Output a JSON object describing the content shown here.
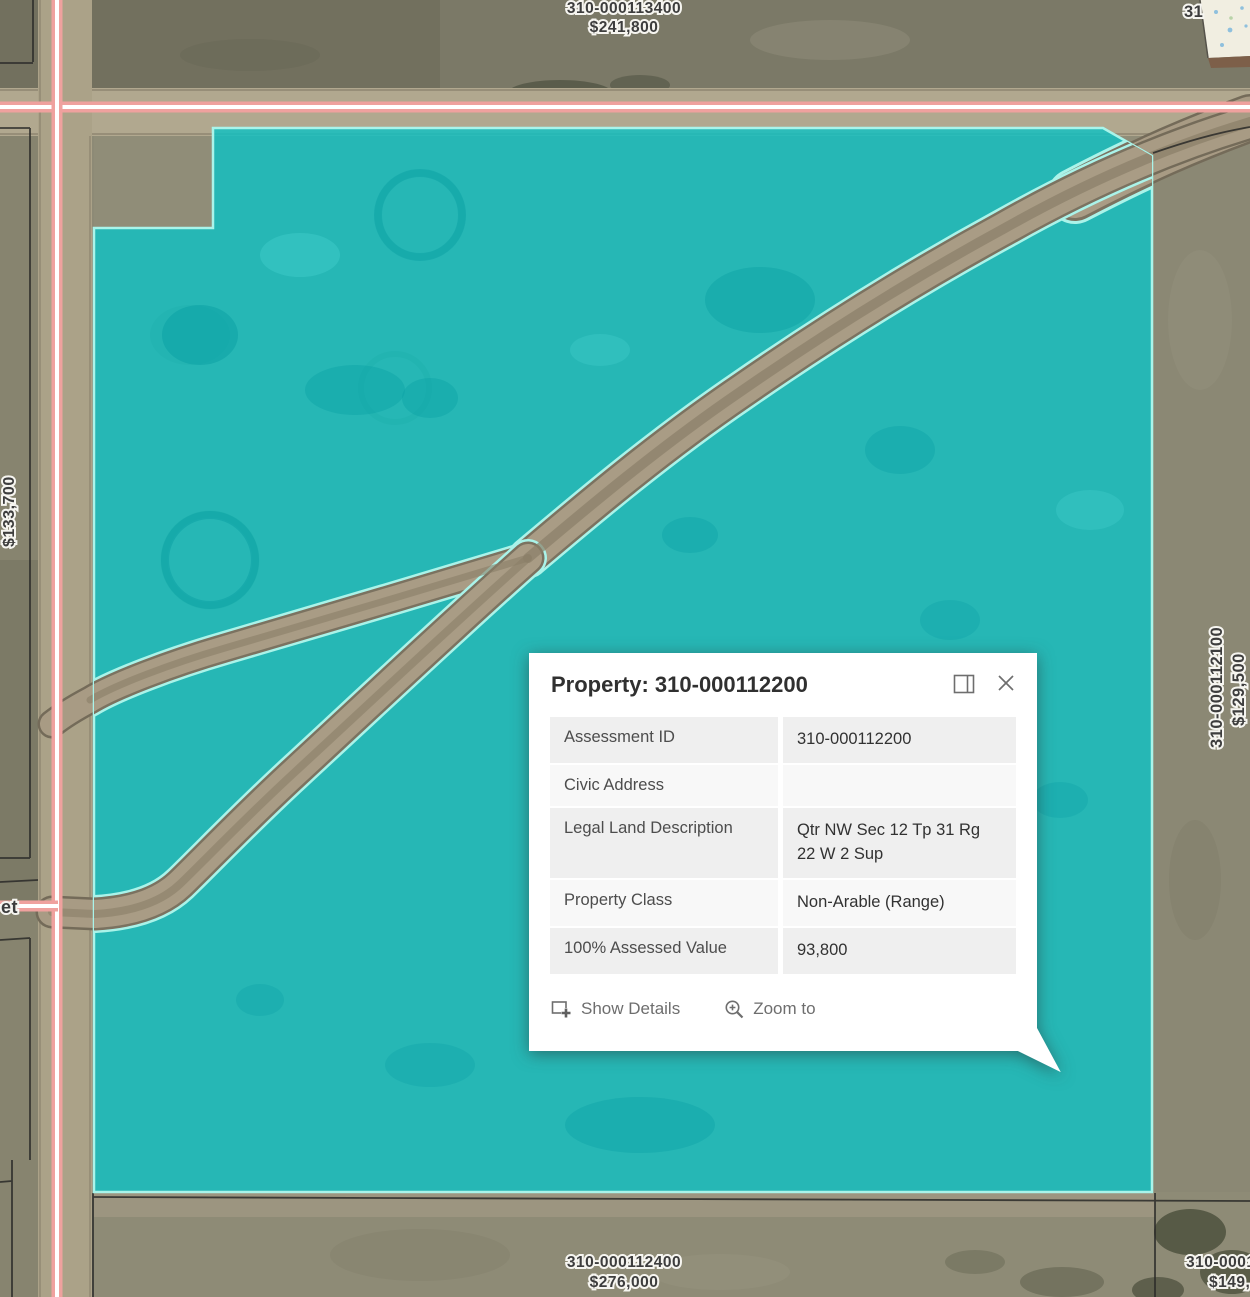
{
  "map": {
    "parcel_labels": {
      "north_id": "310-000113400",
      "north_value": "$241,800",
      "south_id": "310-000112400",
      "south_value": "$276,000",
      "east_id": "310-000112100",
      "east_value": "$129,500",
      "west_value": "$133,700",
      "southeast_id_fragment": "310-0001",
      "southeast_value_fragment": "$149,",
      "northeast_fragment": "31",
      "street_fragment": "et"
    },
    "colors": {
      "highlight_fill": "#0fc1c2",
      "highlight_border": "#a9f4ea",
      "road_line": "#efa19e",
      "trail": "#a89b84"
    }
  },
  "popup": {
    "title": "Property: 310-000112200",
    "rows": [
      {
        "label": "Assessment ID",
        "value": "310-000112200"
      },
      {
        "label": "Civic Address",
        "value": ""
      },
      {
        "label": "Legal Land Description",
        "value": "Qtr NW Sec 12 Tp 31 Rg 22 W 2 Sup"
      },
      {
        "label": "Property Class",
        "value": "Non-Arable (Range)"
      },
      {
        "label": "100% Assessed Value",
        "value": "93,800"
      }
    ],
    "actions": {
      "show_details": "Show Details",
      "zoom_to": "Zoom to"
    }
  }
}
